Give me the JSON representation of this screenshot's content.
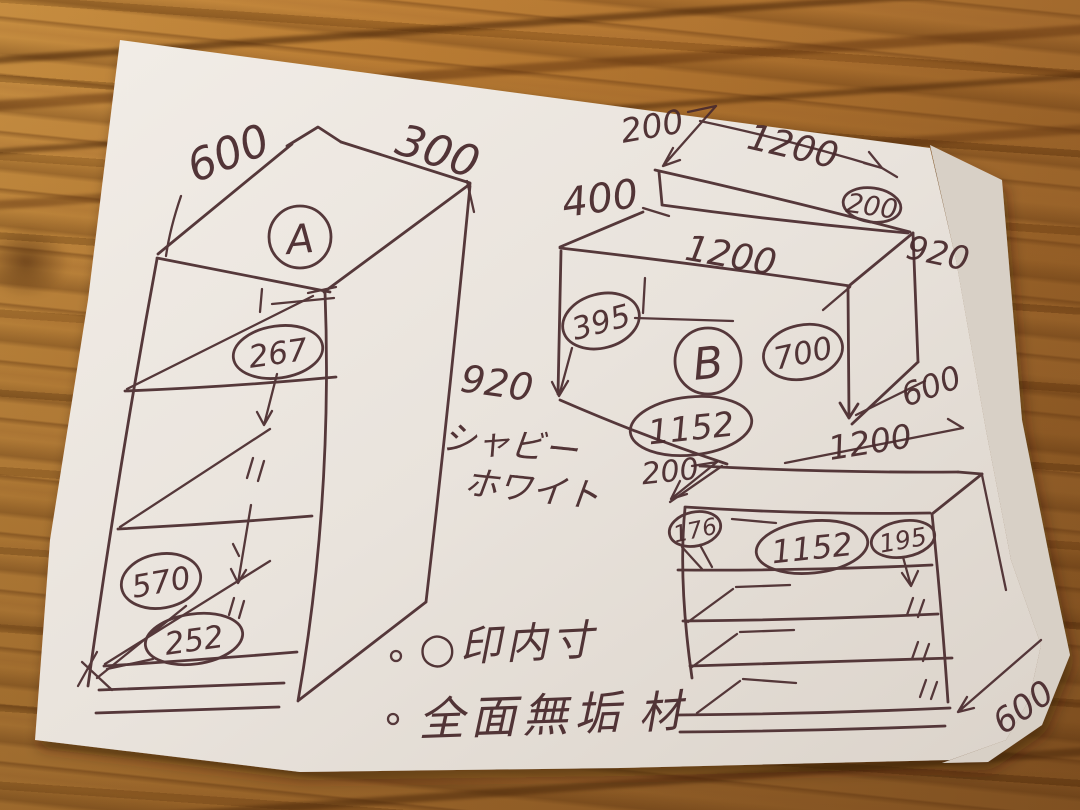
{
  "colors": {
    "ink": "#4a2b2e",
    "paper": "#ece6df",
    "paper_under": "#d8d0c6",
    "wood_base": "#ab6e2a",
    "wood_dark": "#7c4a1a",
    "wood_light": "#c98f3f"
  },
  "units": {
    "a": {
      "letter": "A",
      "width": "600",
      "depth": "300",
      "height": "920",
      "inner_heights": [
        "267",
        "570",
        "252"
      ]
    },
    "b": {
      "letter": "B",
      "top_offset": "200",
      "top_width": "1200",
      "back_height": "400",
      "top_inner": "200",
      "side_height": "920",
      "front_width": "1200",
      "left_inner": "395",
      "inner_height": "700",
      "depth": "600",
      "inner_width": "1152",
      "bottom_width": "1200"
    },
    "c": {
      "top_offset": "200",
      "left_inner": "176",
      "inner_width": "1152",
      "drawer_height": "195",
      "depth": "600"
    }
  },
  "finish": {
    "line1": "シャビー",
    "line2": "ホワイト"
  },
  "notes": {
    "note1": "○印内寸",
    "note2": "全面無垢",
    "note2_suffix": "材"
  }
}
